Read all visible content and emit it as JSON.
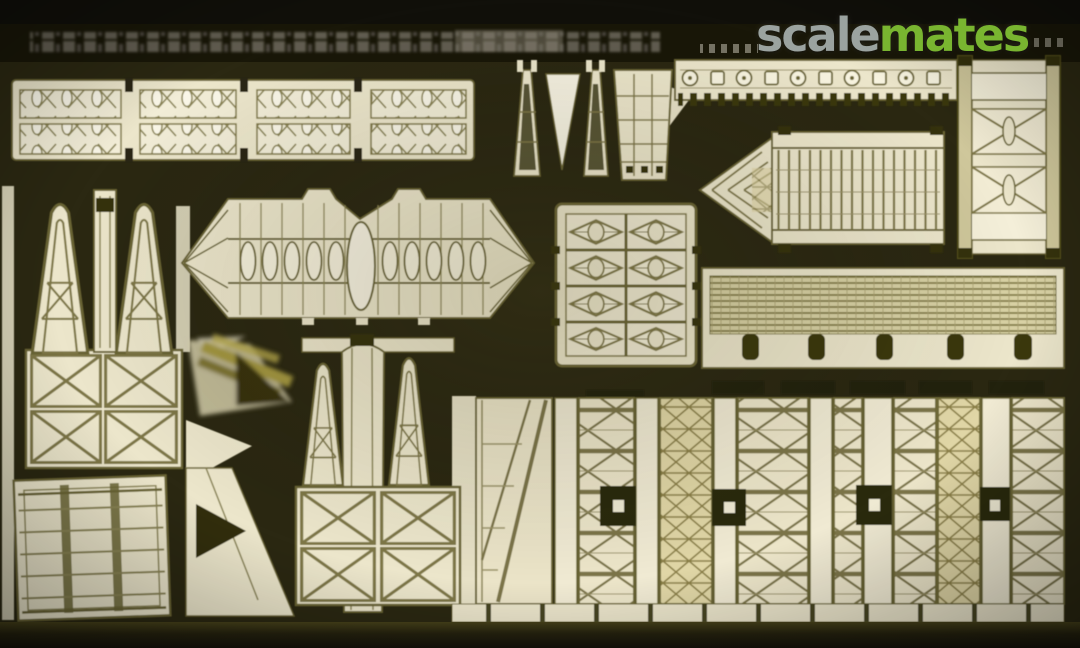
{
  "watermark": {
    "scale": "scale",
    "mates": "mates"
  },
  "colors": {
    "background_olive": "#2b2812",
    "film_band_black": "#11100a",
    "part_cream": "#ece6cb",
    "part_bright": "#f7f3e2",
    "etch_outline": "#6b6535",
    "etch_detail": "#7e7746",
    "brass_gold": "#9a8d3c",
    "dark_tab": "#23210b",
    "logo_gray": "#9ba3a0",
    "logo_green": "#79b530"
  }
}
